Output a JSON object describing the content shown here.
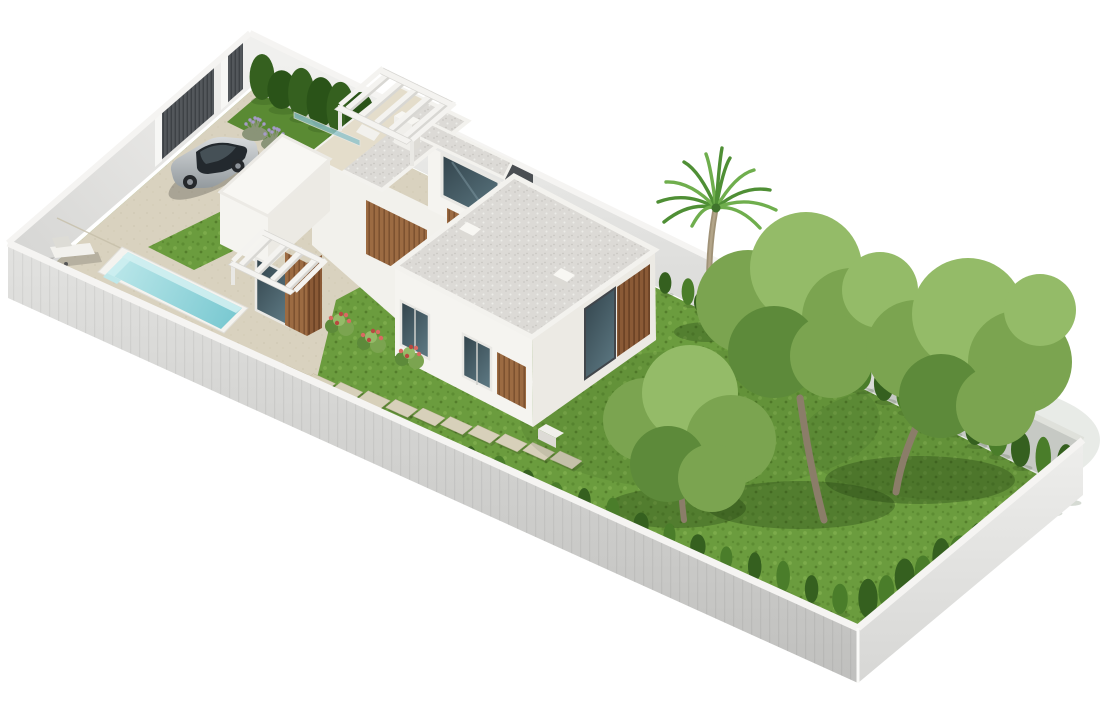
{
  "scene": {
    "type": "3d-architectural-render",
    "description": "Isometric 3D rendering of a modern white villa on a walled rectangular plot: driveway with silver car and slatted gate, rectangular turquoise pool with sun lounger, white flat-roofed volumes with wood-slat panels, rooftop pergola and chimney, gravel roofs with skylights, lawns with stepping stones, cypress hedges, one palm tree and three large garden trees, on a pure white background",
    "background": "#ffffff"
  },
  "colors": {
    "background": "#ffffff",
    "wall_cap": "#f5f4f2",
    "wall_nw_light": "#f2f1ef",
    "wall_nw_dark": "#d6d6d4",
    "wall_ne_light": "#f0f0ee",
    "wall_ne_dark": "#dadad8",
    "wall_sw_light": "#e2e2e0",
    "wall_sw_dark": "#bfbfbd",
    "wall_se_light": "#eeeeec",
    "wall_se_dark": "#d6d6d4",
    "gate_slat": "#53575b",
    "gate_slat_dark": "#3e4246",
    "gate_pillar": "#f7f7f5",
    "wall_door": "#4a4e52",
    "terrace": "#d9d2bf",
    "terrace_dot": "#cdc5b0",
    "terrace_upper": "#e4ddcb",
    "terrace_seam": "#c6bfa9",
    "grass": "#6b9c3e",
    "grass_dot1": "#5d8c33",
    "grass_dot2": "#7cab4b",
    "grass_dot3": "#547e2b",
    "grass_bed": "#5a8a33",
    "shadow_green": "#1e3a10",
    "hedge_dark": "#35601f",
    "hedge_darker": "#2a5318",
    "hedge_mid": "#4a7d2a",
    "canopy": "#7ba450",
    "canopy_light": "#94bb68",
    "canopy_dark": "#5d8a3a",
    "tree_trunk": "#8b7d69",
    "palm_trunk": "#a09277",
    "palm_trunk_hl": "#b3a589",
    "palm_frond": "#4f8f35",
    "palm_frond_light": "#6fae4d",
    "palm_core": "#3f732c",
    "pool_rim": "#f4f3ef",
    "pool_light": "#bfe9eb",
    "pool_deep": "#74c6cf",
    "pool_wall": "#d2f0f1",
    "roof_gravel": "#dcdad6",
    "gravel_dot1": "#cac8c3",
    "gravel_dot2": "#edece8",
    "gravel_dot3": "#c2c0bb",
    "roof_white": "#f8f7f3",
    "house_sw": "#f5f4f0",
    "house_se": "#eceae4",
    "house_body": "#f2f1ec",
    "parapet": "#f3f2ee",
    "wood": "#9c6b42",
    "wood_stripe": "#7d5230",
    "wood_dark": "#8a5a36",
    "wood_dark_stripe": "#6d4426",
    "glass_top": "#32434b",
    "glass_bot": "#5a757f",
    "glass_teal": "#8fc3cb",
    "frame_white": "#e9e8e4",
    "frame_dark": "#41464b",
    "pergola_white": "#f4f3f0",
    "pergola_shade": "#d8d7d3",
    "car_light": "#d7dadc",
    "car_dark": "#939a9e",
    "car_glass": "#23292e",
    "car_wheel": "#25282b",
    "stone": "#d7d0ba",
    "stone_edge": "#c2ba9f",
    "lounger": "#f2f1ed",
    "lounger_shade": "#dddcd6",
    "flower_pink": "#d96a62",
    "flower_red": "#b84a40",
    "lavender_leaf": "#8a9478",
    "lavender_bloom": "#a59bc8",
    "chimney_sw": "#f0efeb",
    "chimney_se": "#dddbd5",
    "ac_top": "#f1f0ec",
    "ac_front": "#dddbd6"
  },
  "plot": {
    "wall_height": 55,
    "corners": {
      "north": [
        250,
        33
      ],
      "east": [
        1083,
        440
      ],
      "south": [
        858,
        628
      ],
      "west": [
        8,
        243
      ]
    }
  },
  "pergolas": [
    {
      "name": "roof-pergola",
      "slot": "g-roof-pergola",
      "n": [
        383,
        68
      ],
      "e": [
        455,
        103
      ],
      "s": [
        412,
        140
      ],
      "w": [
        340,
        105
      ],
      "rafters": 5,
      "beam": 7,
      "posts": [
        [
          340,
          105,
          26
        ],
        [
          412,
          140,
          26
        ]
      ]
    },
    {
      "name": "entrance-pergola",
      "slot": "g-entrance-pergola",
      "n": [
        264,
        230
      ],
      "e": [
        326,
        260
      ],
      "s": [
        295,
        291
      ],
      "w": [
        233,
        261
      ],
      "rafters": 4,
      "beam": 6,
      "posts": [
        [
          233,
          261,
          24
        ]
      ]
    }
  ],
  "hedge_runs": [
    {
      "name": "hedge-row-gate",
      "layer": "far",
      "from": [
        262,
        100
      ],
      "to": [
        360,
        145
      ],
      "count": 6,
      "h0": 42,
      "h1": 52,
      "rx": 14,
      "colors": [
        "hedge_dark",
        "hedge_darker"
      ]
    },
    {
      "name": "hedge-row-north",
      "layer": "far",
      "from": [
        505,
        215
      ],
      "to": [
        688,
        305
      ],
      "count": 9,
      "h0": 16,
      "h1": 24,
      "rx": 6,
      "colors": [
        "hedge_mid",
        "hedge_dark"
      ]
    },
    {
      "name": "hedge-row-northeast",
      "layer": "far",
      "from": [
        702,
        313
      ],
      "to": [
        1066,
        489
      ],
      "count": 17,
      "h0": 24,
      "h1": 40,
      "rx": 9,
      "colors": [
        "hedge_dark",
        "hedge_mid"
      ]
    },
    {
      "name": "hedge-row-southeast",
      "layer": "far",
      "from": [
        1070,
        502
      ],
      "to": [
        868,
        618
      ],
      "count": 12,
      "h0": 26,
      "h1": 38,
      "rx": 9,
      "colors": [
        "hedge_mid",
        "hedge_dark"
      ]
    },
    {
      "name": "hedge-row-southwest",
      "layer": "near",
      "from": [
        300,
        404
      ],
      "to": [
        840,
        614
      ],
      "count": 20,
      "h0": 18,
      "h1": 30,
      "rx": 7,
      "colors": [
        "hedge_dark",
        "hedge_mid"
      ]
    }
  ],
  "stepping_stones": {
    "from": [
      292,
      374
    ],
    "to": [
      566,
      460
    ],
    "count": 11,
    "u": [
      11,
      5
    ],
    "v": [
      -5,
      4
    ]
  },
  "trees": [
    {
      "name": "garden-tree-middle",
      "trunk": "M824,520 Q810,468 800,398",
      "trunk_w": 7,
      "shadow": [
        800,
        505,
        95,
        24
      ],
      "blobs": [
        [
          748,
          302,
          52,
          "canopy"
        ],
        [
          806,
          268,
          56,
          "canopy_light"
        ],
        [
          852,
          318,
          50,
          "canopy"
        ],
        [
          774,
          352,
          46,
          "canopy_dark"
        ],
        [
          832,
          356,
          42,
          "canopy"
        ],
        [
          880,
          290,
          38,
          "canopy_light"
        ]
      ]
    },
    {
      "name": "garden-tree-right",
      "trunk": "M896,492 Q903,448 929,402",
      "trunk_w": 7,
      "shadow": [
        920,
        480,
        95,
        24
      ],
      "blobs": [
        [
          916,
          350,
          50,
          "canopy"
        ],
        [
          968,
          314,
          56,
          "canopy_light"
        ],
        [
          1020,
          362,
          52,
          "canopy"
        ],
        [
          941,
          396,
          42,
          "canopy_dark"
        ],
        [
          996,
          406,
          40,
          "canopy"
        ],
        [
          1040,
          310,
          36,
          "canopy_light"
        ]
      ]
    },
    {
      "name": "garden-tree-left",
      "trunk": "M684,520 Q679,480 681,452",
      "trunk_w": 6,
      "shadow": [
        676,
        508,
        70,
        20
      ],
      "blobs": [
        [
          645,
          420,
          42,
          "canopy"
        ],
        [
          690,
          393,
          48,
          "canopy_light"
        ],
        [
          731,
          440,
          45,
          "canopy"
        ],
        [
          668,
          464,
          38,
          "canopy_dark"
        ],
        [
          712,
          478,
          34,
          "canopy"
        ]
      ]
    }
  ],
  "palm": {
    "name": "palm-tree",
    "trunk": "M712,330 Q705,268 715,212",
    "trunk_w": 6,
    "top": [
      716,
      208
    ],
    "shadow": [
      708,
      332,
      34,
      10
    ],
    "ctrl_lift": 14,
    "fronds": [
      [
        -58,
        -6
      ],
      [
        -50,
        -26
      ],
      [
        -32,
        -46
      ],
      [
        -10,
        -54
      ],
      [
        14,
        -50
      ],
      [
        38,
        -38
      ],
      [
        54,
        -18
      ],
      [
        60,
        2
      ],
      [
        -52,
        14
      ],
      [
        44,
        20
      ],
      [
        6,
        -60
      ],
      [
        -24,
        18
      ]
    ]
  },
  "flowers": [
    {
      "x": 340,
      "y": 323
    },
    {
      "x": 372,
      "y": 340
    },
    {
      "x": 410,
      "y": 356
    }
  ],
  "lavender": [
    {
      "x": 255,
      "y": 134
    },
    {
      "x": 274,
      "y": 144
    }
  ]
}
